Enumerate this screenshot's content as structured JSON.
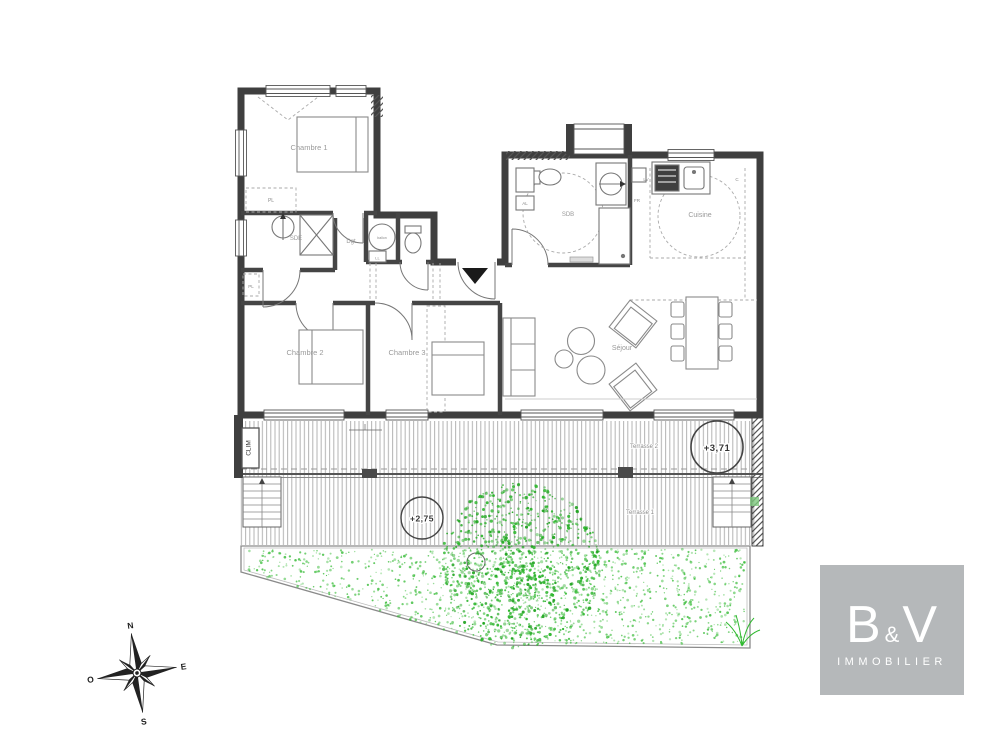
{
  "plan": {
    "rooms": {
      "chambre1": "Chambre 1",
      "chambre2": "Chambre 2",
      "chambre3": "Chambre 3",
      "sde": "SDE",
      "dgt": "Dgt",
      "sdb": "SDB",
      "cuisine": "Cuisine",
      "sejour": "Séjour"
    },
    "annotations": {
      "clim": "CLIM",
      "terrasse1": "Terrasse 1",
      "terrasse2": "Terrasse 2",
      "level_upper": "+3,71",
      "level_lower": "+2,75",
      "ballon": "ballon",
      "pl": "PL",
      "ll": "LL",
      "al": "AL",
      "lv": "LV",
      "c": "C",
      "fr": "FR"
    },
    "compass": {
      "n": "N",
      "s": "S",
      "e": "E",
      "o": "O"
    }
  },
  "logo": {
    "b": "B",
    "amp": "&",
    "v": "V",
    "subtitle": "IMMOBILIER"
  },
  "colors": {
    "wall": "#3f3f3f",
    "line": "#666666",
    "label": "#9a9a9a",
    "vegetation_green": "#2eb82e",
    "logo_background": "#b5b8ba"
  }
}
